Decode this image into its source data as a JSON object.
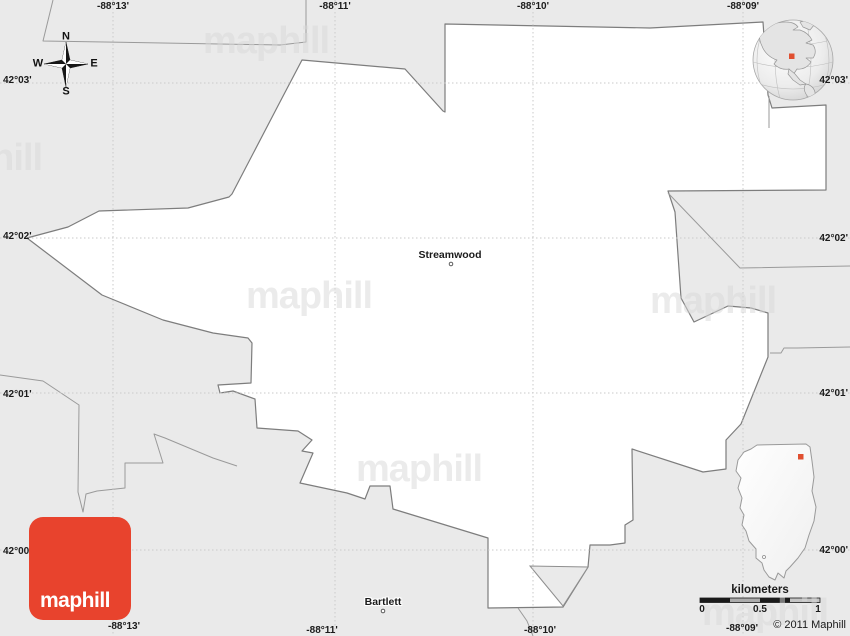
{
  "map_labels": {
    "place": "Streamwood",
    "neighbor": "Bartlett"
  },
  "grid": {
    "top": [
      "-88°13'",
      "-88°11'",
      "-88°10'",
      "-88°09'"
    ],
    "bottom": [
      "-88°13'",
      "-88°11'",
      "-88°10'",
      "-88°09'"
    ],
    "left": [
      "42°03'",
      "42°02'",
      "42°01'",
      "42°00'"
    ],
    "right": [
      "42°03'",
      "42°02'",
      "42°01'",
      "42°00'"
    ]
  },
  "compass": {
    "n": "N",
    "s": "S",
    "e": "E",
    "w": "W"
  },
  "scale": {
    "title": "kilometers",
    "ticks": [
      "0",
      "0.5",
      "1"
    ]
  },
  "branding": {
    "logo": "maphill",
    "watermark": "maphill",
    "copyright": "© 2011 Maphill"
  },
  "colors": {
    "accent_red": "#e8432d",
    "marker_red": "#e04f30",
    "background_gray": "#eaeaea",
    "area_white": "#ffffff",
    "boundary_gray": "#8f8f8f"
  }
}
